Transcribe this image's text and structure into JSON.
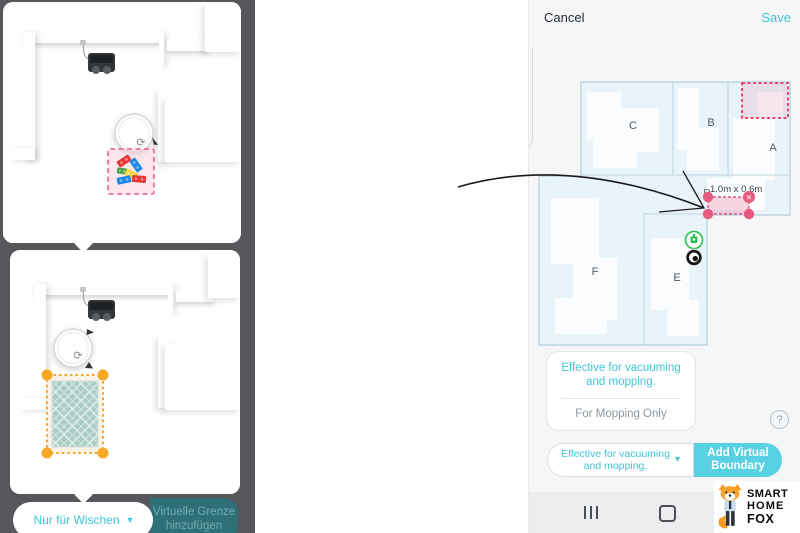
{
  "colors": {
    "accent_cyan": "#41C5D6",
    "add_button_bg": "#58D1E3",
    "boundary_pink": "#E8517A",
    "nogo_zone_red": "#E8486E",
    "rug_handle_orange": "#F5A623",
    "dock_green": "#27C24C",
    "mop_button_teal_bg": "#2E6F78",
    "left_backdrop_gray": "#56575A"
  },
  "left_panel": {
    "mop_only_button": {
      "label": "Nur für Wischen",
      "caret": "▾"
    },
    "add_boundary_button": {
      "line1": "Virtuelle Grenze",
      "line2": "hinzufügen"
    }
  },
  "phone": {
    "header": {
      "cancel": "Cancel",
      "save": "Save"
    },
    "map": {
      "rooms": [
        {
          "label": "A"
        },
        {
          "label": "B"
        },
        {
          "label": "C"
        },
        {
          "label": "D"
        },
        {
          "label": "E"
        },
        {
          "label": "F"
        }
      ],
      "boundary_dimensions": "1.0m x 0.6m",
      "delete_glyph": "✕"
    },
    "popup": {
      "primary_line1": "Effective for vacuuming",
      "primary_line2": "and mopping.",
      "secondary": "For Mopping Only"
    },
    "help_glyph": "?",
    "toolbar": {
      "mode_dropdown_line1": "Effective for vacuuming",
      "mode_dropdown_line2": "and mopping.",
      "caret": "▾",
      "add_button_line1": "Add Virtual",
      "add_button_line2": "Boundary"
    },
    "logo": {
      "word1": "SMART",
      "word2": "HOME",
      "word3": "FOX"
    }
  }
}
